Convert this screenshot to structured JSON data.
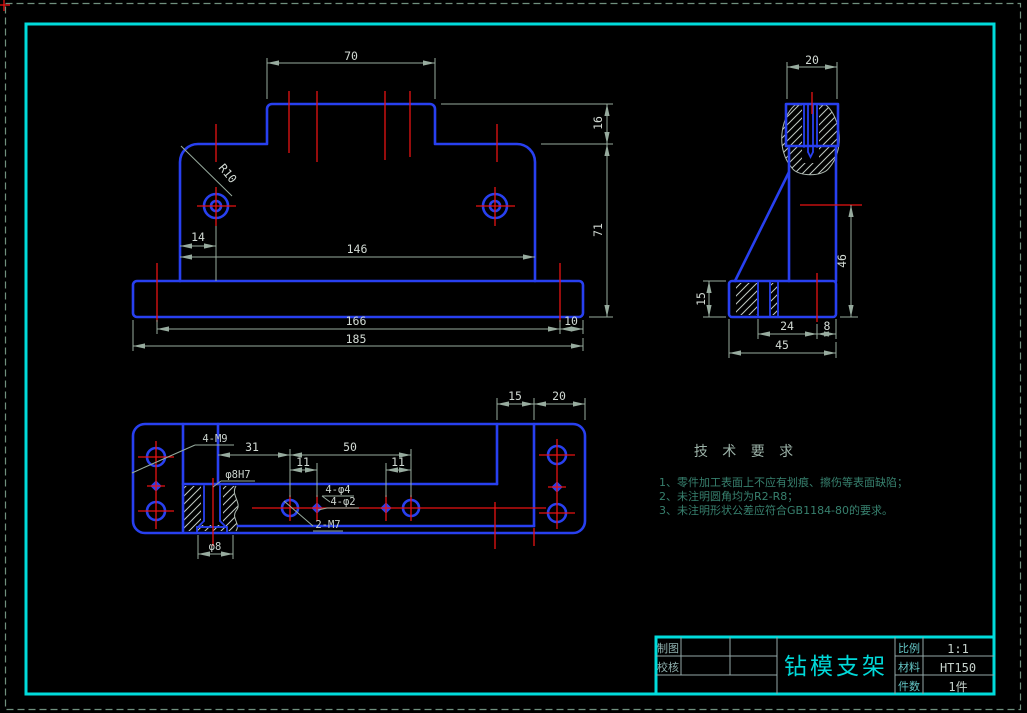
{
  "drawing": {
    "part_name": "钻模支架",
    "type": "CAD engineering drawing"
  },
  "colors": {
    "background": "#000000",
    "geometry_blue": "#2840f0",
    "centerline_red": "#e81212",
    "dimension_gray": "#97ab9e",
    "frame_cyan": "#00dcdc",
    "annotation_teal": "#37806e"
  },
  "front_view": {
    "dims": {
      "boss_width": "70",
      "boss_height": "16",
      "body_height": "71",
      "body_width": "146",
      "hole_offset": "14",
      "hole_spacing": "166",
      "edge_offset": "10",
      "base_width": "185",
      "fillet_radius": "R10"
    }
  },
  "side_view": {
    "dims": {
      "boss_width": "20",
      "wall_height": "46",
      "base_height": "15",
      "hole_offset": "24",
      "edge_offset": "8",
      "base_depth": "45"
    }
  },
  "bottom_view": {
    "dims": {
      "wall_inset": "15",
      "flange_width": "20",
      "hole_offset": "31",
      "hole_spacing": "50",
      "pin_offset_left": "11",
      "pin_offset_right": "11"
    },
    "labels": {
      "corner_thread_holes": "4-M9",
      "center_hole": "φ8H7",
      "pin_holes_top": "4-φ4",
      "pin_holes_bottom": "4-φ2",
      "thread_holes": "2-M7",
      "counterbore": "φ8"
    }
  },
  "tech_requirements": {
    "title": "技 术 要 求",
    "items": [
      "1、零件加工表面上不应有划痕、擦伤等表面缺陷；",
      "2、未注明圆角均为R2-R8；",
      "3、未注明形状公差应符合GB1184-80的要求。"
    ]
  },
  "title_block": {
    "drafter_label": "制图",
    "checker_label": "校核",
    "part_name": "钻模支架",
    "scale_label": "比例",
    "scale_value": "1:1",
    "material_label": "材料",
    "material_value": "HT150",
    "quantity_label": "件数",
    "quantity_value": "1件"
  }
}
